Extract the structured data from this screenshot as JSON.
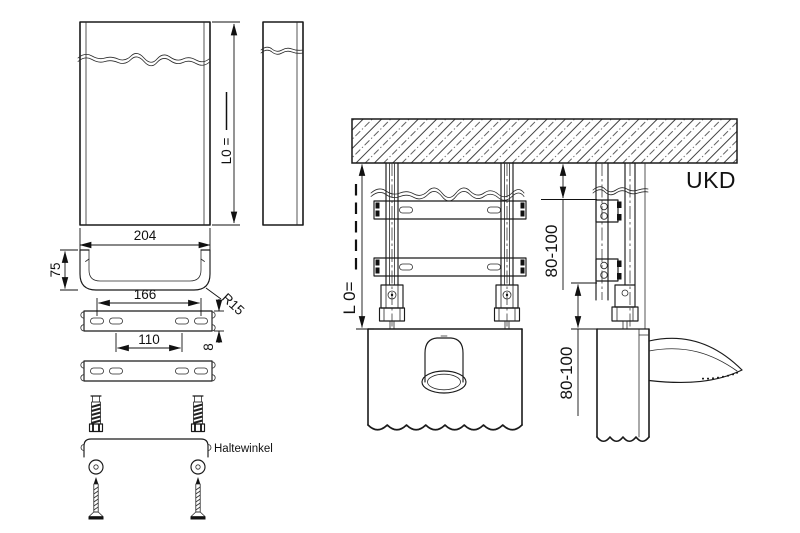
{
  "drawing": {
    "labels": {
      "ukd": "UKD",
      "bracket_part": "Haltewinkel"
    },
    "dims": {
      "panel_length_blank": "L0 =",
      "panel_width": "204",
      "channel_height": "75",
      "corner_radius": "R15",
      "hole_spacing_outer": "166",
      "hole_spacing_inner": "110",
      "rail_thickness": "8",
      "install_length_blank": "L 0=",
      "ceiling_offset_upper": "80-100",
      "ceiling_offset_lower": "80-100"
    }
  }
}
